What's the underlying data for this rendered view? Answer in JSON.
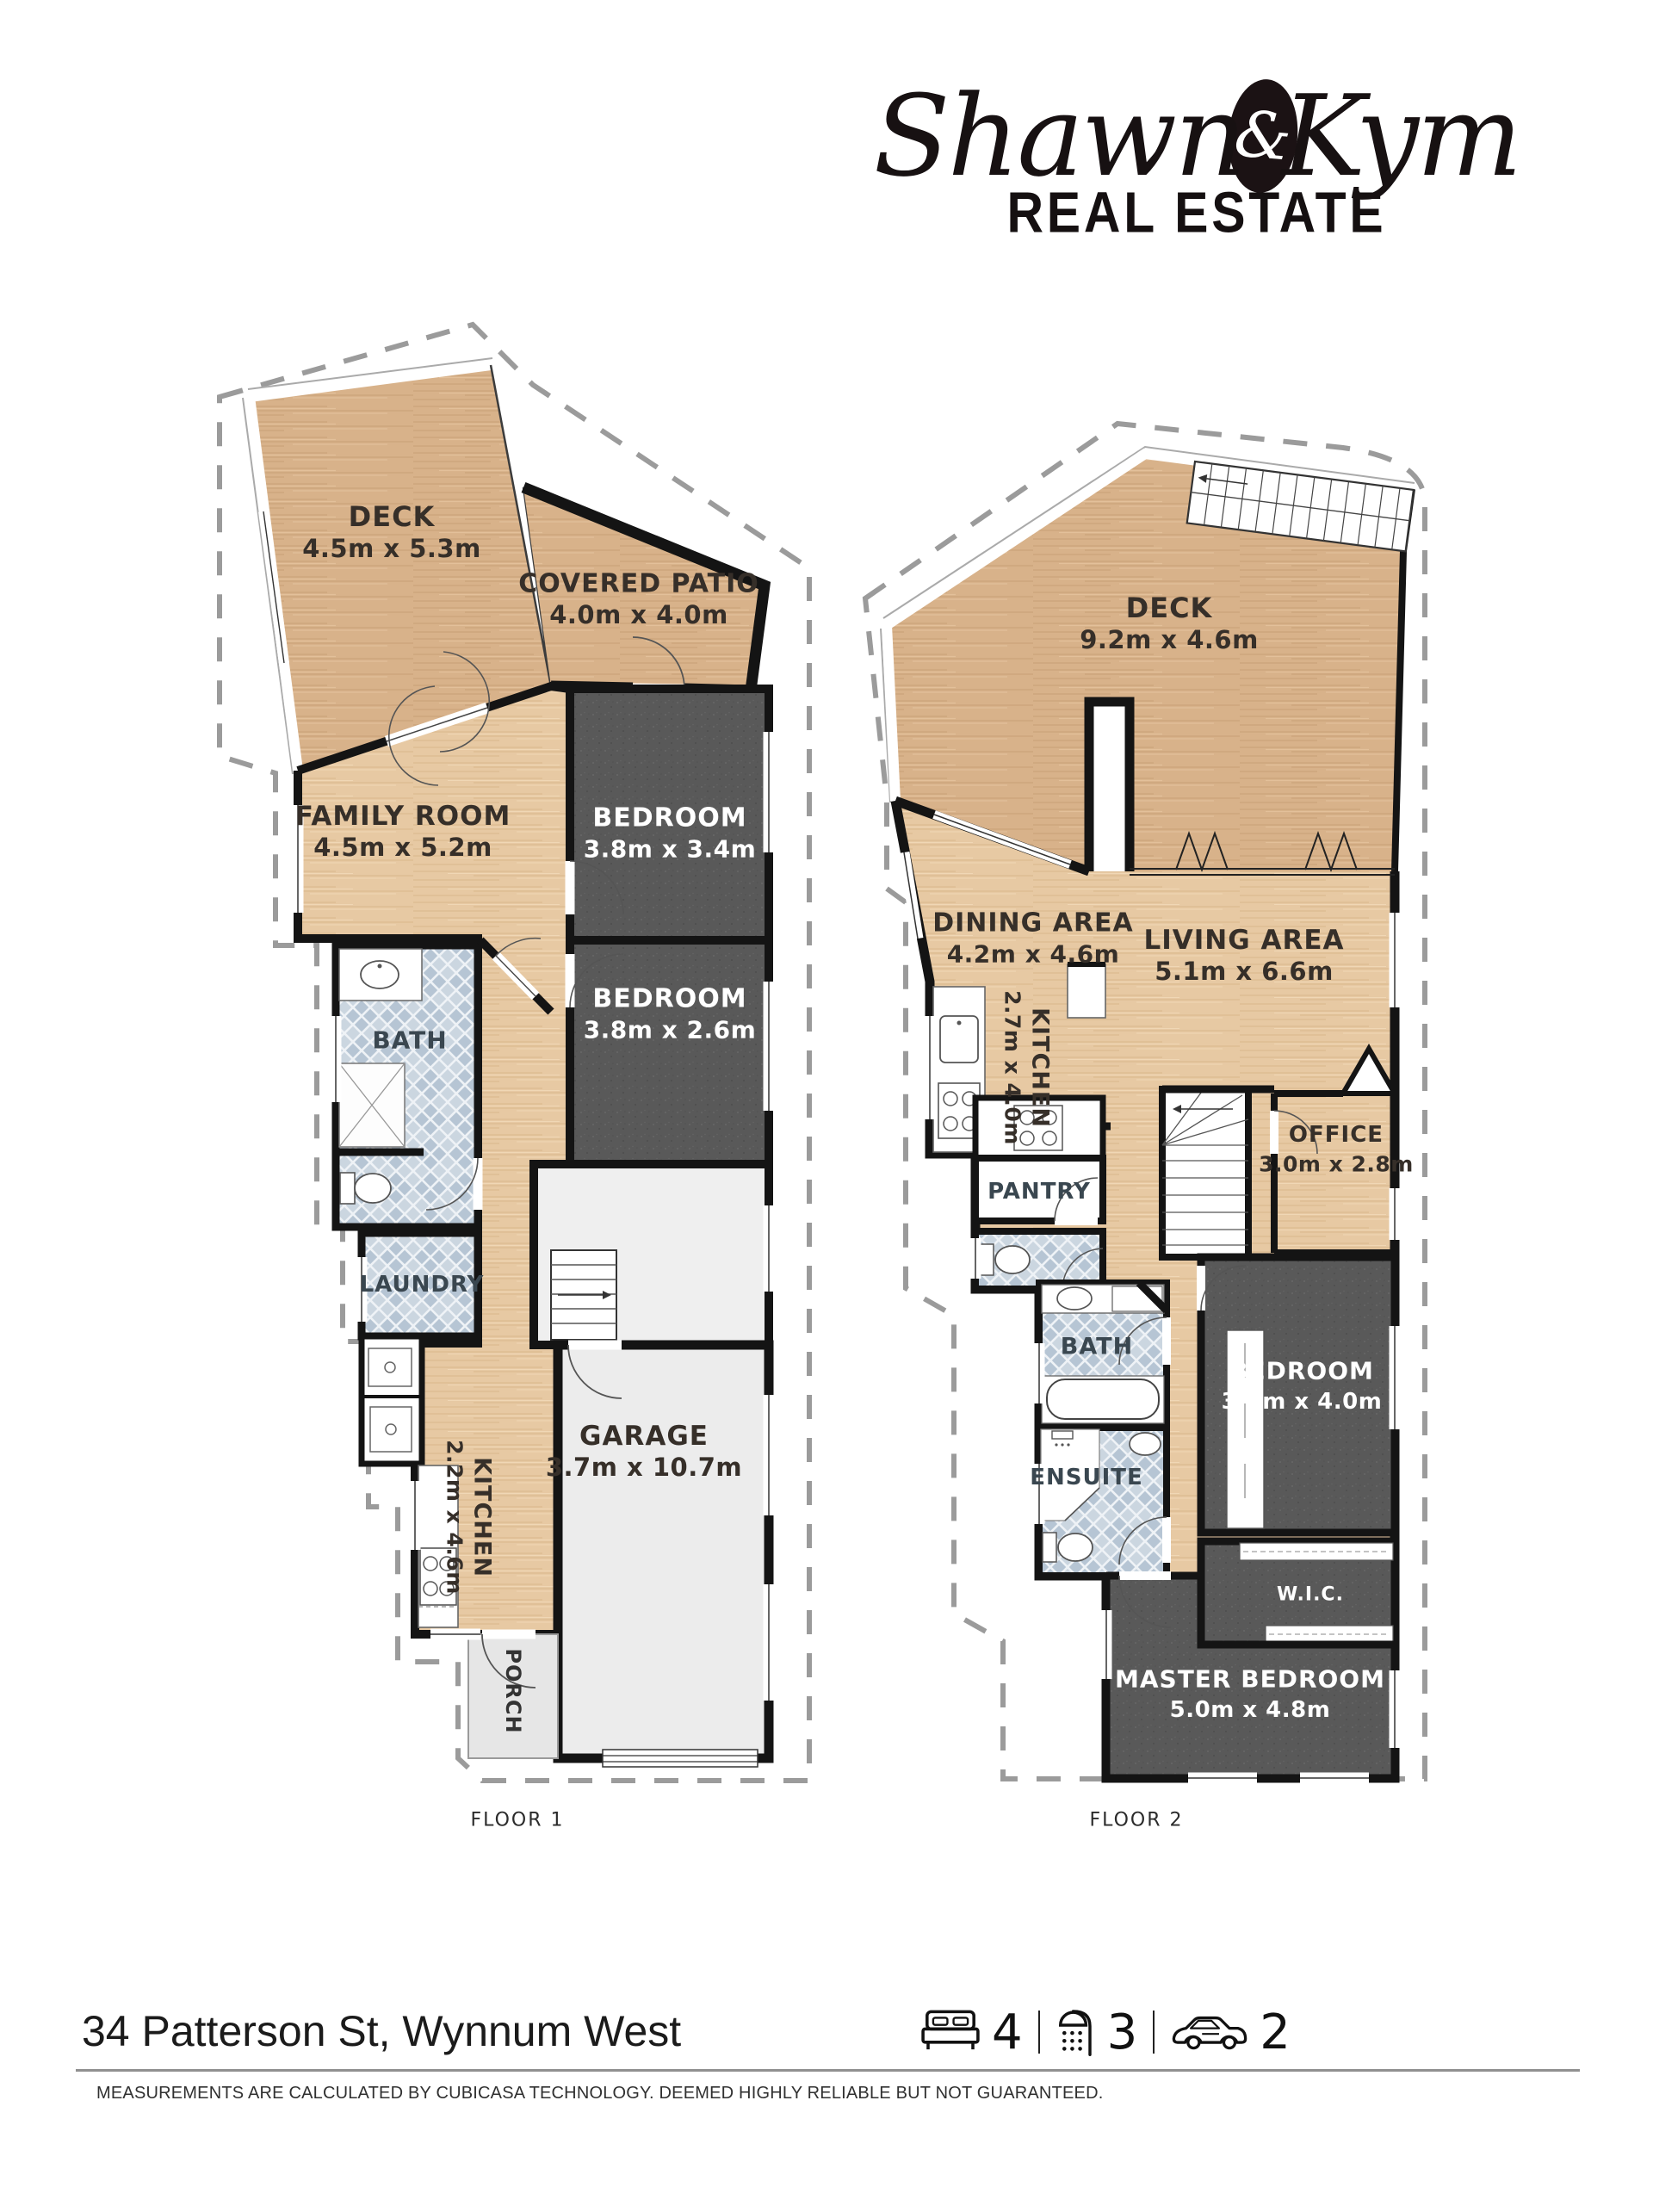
{
  "logo": {
    "first": "Shawn",
    "amp": "&",
    "second": "Kym",
    "tagline": "REAL ESTATE"
  },
  "floor1": {
    "label": "FLOOR 1",
    "rooms": {
      "deck": {
        "name": "DECK",
        "dims": "4.5m x 5.3m"
      },
      "patio": {
        "name": "COVERED PATIO",
        "dims": "4.0m x 4.0m"
      },
      "family": {
        "name": "FAMILY ROOM",
        "dims": "4.5m x 5.2m"
      },
      "bedroom1": {
        "name": "BEDROOM",
        "dims": "3.8m x 3.4m"
      },
      "bedroom2": {
        "name": "BEDROOM",
        "dims": "3.8m x 2.6m"
      },
      "bath": {
        "name": "BATH"
      },
      "laundry": {
        "name": "LAUNDRY"
      },
      "kitchen": {
        "name": "KITCHEN",
        "dims": "2.2m x 4.6m"
      },
      "garage": {
        "name": "GARAGE",
        "dims": "3.7m x 10.7m"
      },
      "porch": {
        "name": "PORCH"
      }
    }
  },
  "floor2": {
    "label": "FLOOR 2",
    "rooms": {
      "deck": {
        "name": "DECK",
        "dims": "9.2m x 4.6m"
      },
      "dining": {
        "name": "DINING AREA",
        "dims": "4.2m x 4.6m"
      },
      "living": {
        "name": "LIVING AREA",
        "dims": "5.1m x 6.6m"
      },
      "kitchen": {
        "name": "KITCHEN",
        "dims": "2.7m x 4.0m"
      },
      "pantry": {
        "name": "PANTRY"
      },
      "office": {
        "name": "OFFICE",
        "dims": "3.0m x 2.8m"
      },
      "bath": {
        "name": "BATH"
      },
      "ensuite": {
        "name": "ENSUITE"
      },
      "bedroom": {
        "name": "BEDROOM",
        "dims": "3.0m x 4.0m"
      },
      "wic": {
        "name": "W.I.C."
      },
      "master": {
        "name": "MASTER BEDROOM",
        "dims": "5.0m x 4.8m"
      }
    }
  },
  "footer": {
    "address": "34 Patterson St, Wynnum West",
    "beds": "4",
    "baths": "3",
    "cars": "2",
    "disclaimer": "MEASUREMENTS ARE CALCULATED BY CUBICASA TECHNOLOGY. DEEMED HIGHLY RELIABLE BUT NOT GUARANTEED."
  },
  "colors": {
    "wood_deck": "#d8b28a",
    "wood_interior": "#e7c9a3",
    "carpet": "#595959",
    "tile_base": "#cbd6e0",
    "tile_diamond": "#b6c5d4",
    "wall": "#141414",
    "garage_floor": "#ececec",
    "boundary_dash": "#9b9b9b"
  }
}
